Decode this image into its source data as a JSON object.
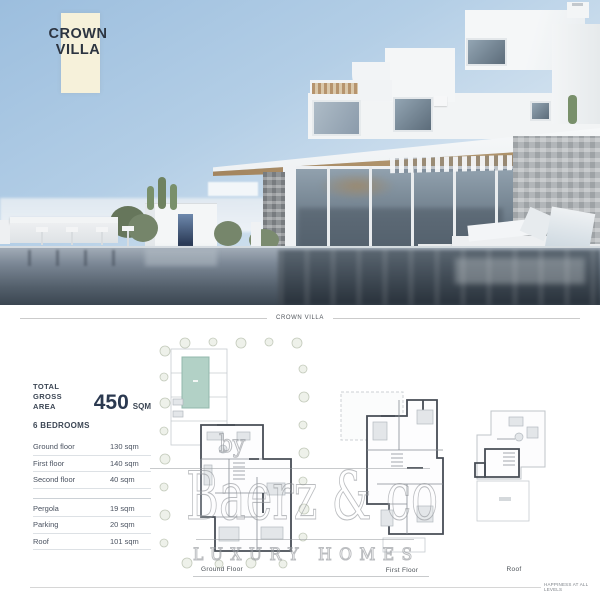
{
  "hero": {
    "badge_line1": "CROWN",
    "badge_line2": "VILLA"
  },
  "section_divider": {
    "title": "CROWN VILLA"
  },
  "info": {
    "total_label_line1": "TOTAL",
    "total_label_line2": "GROSS AREA",
    "total_value": "450",
    "total_unit": "SQM",
    "bedrooms": "6 BEDROOMS",
    "rows_main": [
      {
        "label": "Ground floor",
        "value": "130 sqm"
      },
      {
        "label": "First floor",
        "value": "140 sqm"
      },
      {
        "label": "Second floor",
        "value": "40 sqm"
      }
    ],
    "rows_extra": [
      {
        "label": "Pergola",
        "value": "19 sqm"
      },
      {
        "label": "Parking",
        "value": "20 sqm"
      },
      {
        "label": "Roof",
        "value": "101 sqm"
      }
    ]
  },
  "plans": {
    "ground": {
      "label": "Ground Floor"
    },
    "first": {
      "label": "First Floor"
    },
    "roof": {
      "label": "Roof"
    }
  },
  "watermark": {
    "prefix": "by",
    "brand": "Baerz & co",
    "tagline": "LUXURY HOMES"
  },
  "footer": {
    "tagline": "HAPPINESS AT ALL LEVELS"
  },
  "colors": {
    "badge_bg": "#f6f1da",
    "heading_navy": "#2b3950",
    "text_slate": "#4a5260",
    "plan_pool_teal": "#b2d1c6",
    "watermark_gray": "#929599",
    "sky_top": "#9cbede",
    "pool_water": "#53616d",
    "roof_wood": "#b3976f"
  }
}
